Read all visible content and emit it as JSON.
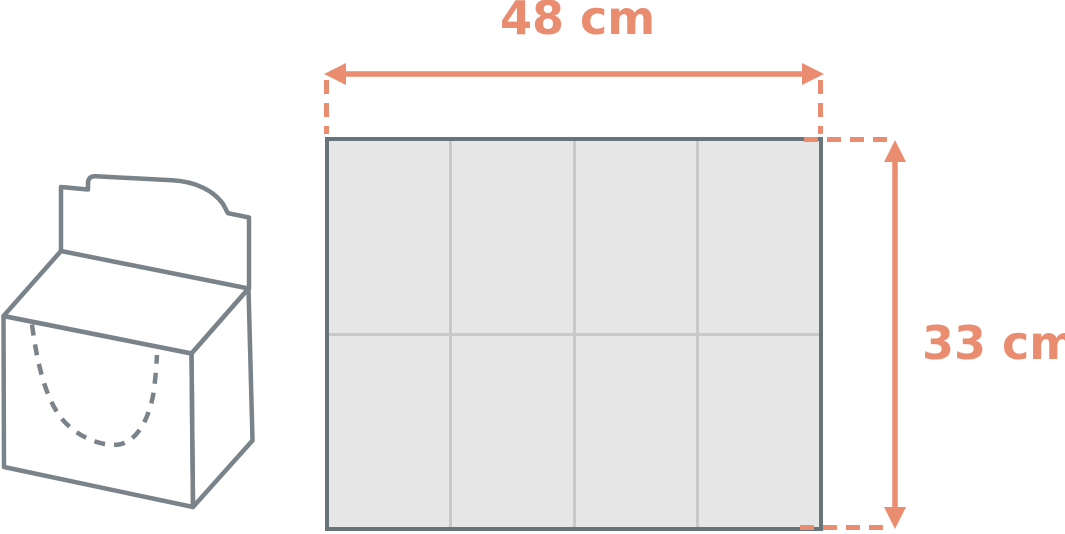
{
  "diagram": {
    "width_dimension": {
      "label": "48 cm"
    },
    "height_dimension": {
      "label": "33 cm"
    },
    "grid": {
      "columns": 4,
      "rows": 2
    },
    "icons": {
      "dispenser_box": "dispenser-box-line-drawing",
      "width_arrow": "double-headed-horizontal-arrow",
      "height_arrow": "double-headed-vertical-arrow"
    },
    "colors": {
      "dimension_accent": "#E98C6F",
      "box_outline": "#7A8389",
      "sheet_border": "#68747B",
      "sheet_grid_line": "#C6C8C9",
      "sheet_cell_fill": "#E6E6E6",
      "background": "#FFFFFF"
    }
  }
}
